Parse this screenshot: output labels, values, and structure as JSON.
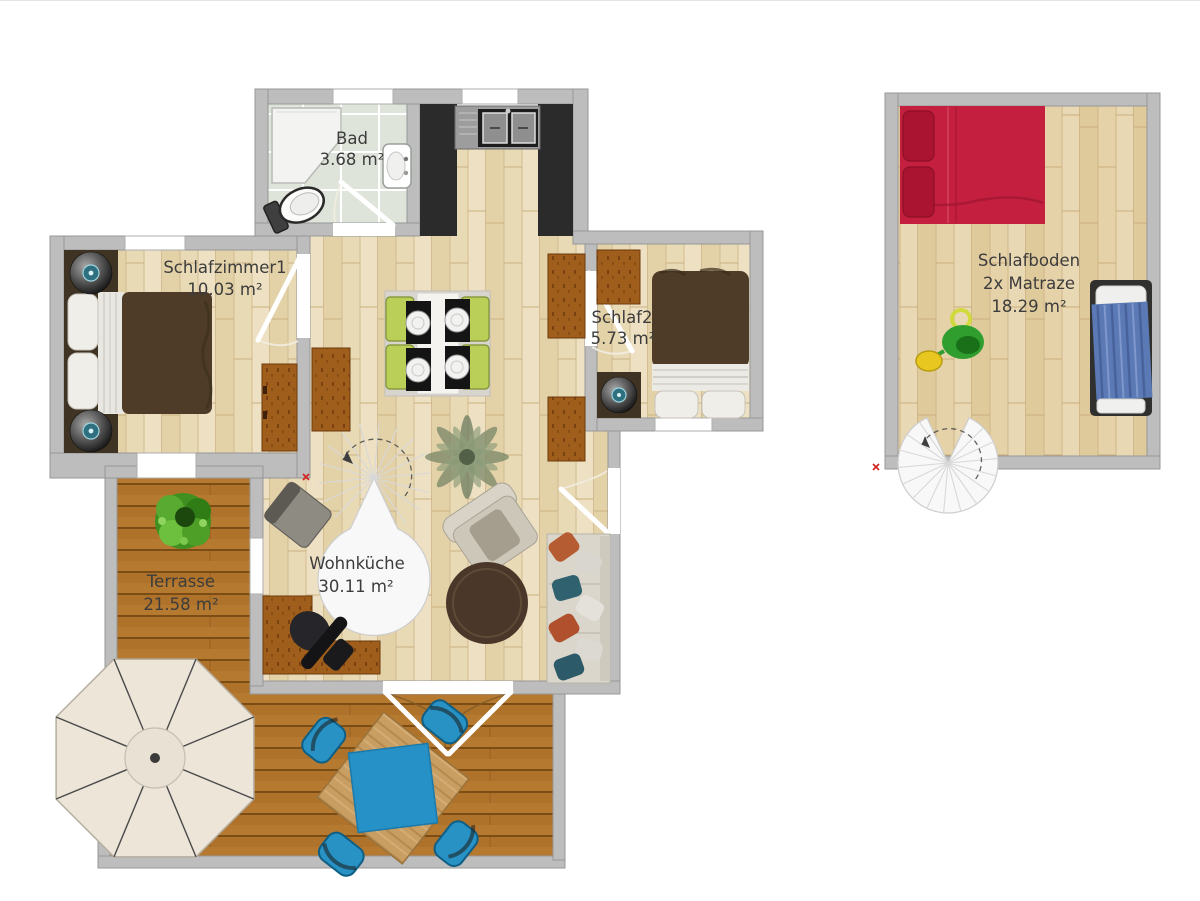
{
  "plan": {
    "title": "Apartment floor plan with sleeping loft",
    "rooms": {
      "bad": {
        "name": "Bad",
        "area": "3.68 m²"
      },
      "schlafzimmer1": {
        "name": "Schlafzimmer1",
        "area": "10.03 m²"
      },
      "schlaf2": {
        "name": "Schlaf2",
        "area": "5.73 m²"
      },
      "wohnkueche": {
        "name": "Wohnküche",
        "area": "30.11 m²"
      },
      "terrasse": {
        "name": "Terrasse",
        "area": "21.58 m²"
      },
      "schlafboden": {
        "name": "Schlafboden",
        "subtitle": "2x Matraze",
        "area": "18.29 m²"
      }
    }
  },
  "colors": {
    "wall": "#bdbdbd",
    "label": "#3c3c3c",
    "floor_wood": "#e9dab6",
    "deck_wood": "#b5792f",
    "bathroom_tile": "#dfe4da",
    "kitchen_cabinet": "#2b2b2b",
    "bed_brown": "#4e3c28",
    "bed_red": "#c41f3e",
    "bed_blue": "#5b79b4",
    "dining_chair_lime": "#b9cf57",
    "terrace_set_blue": "#2892c4",
    "umbrella_cream": "#ece5d8",
    "dresser_brown": "#a05e1d",
    "plant_green": "#3e8f1e"
  }
}
